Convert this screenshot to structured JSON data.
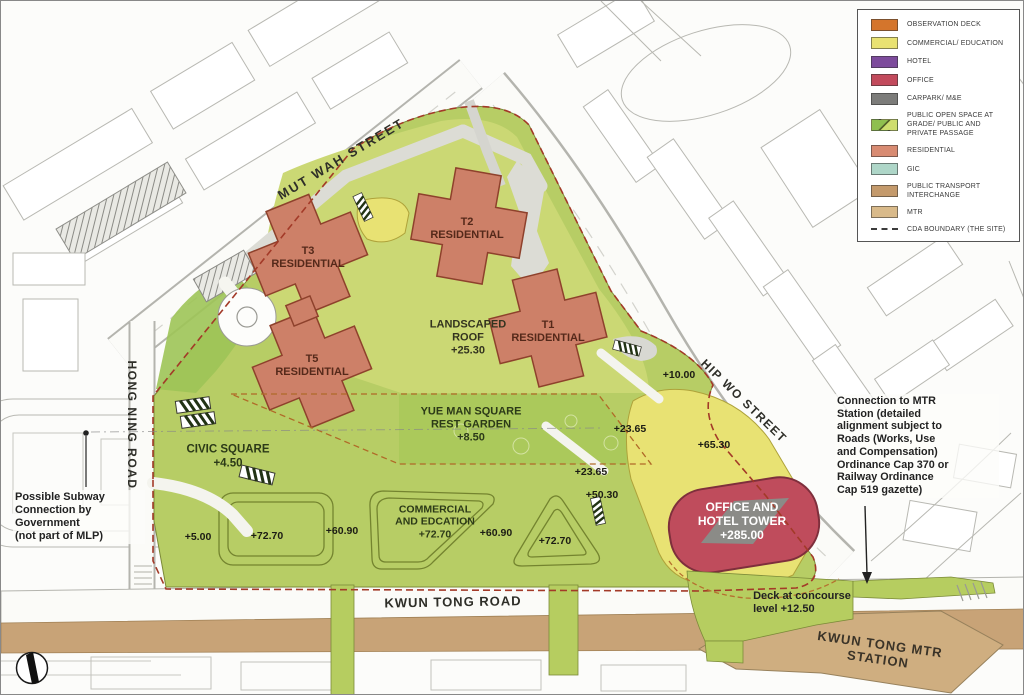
{
  "palette": {
    "observation_deck": "#d4752c",
    "commercial_education": "#e9e272",
    "hotel": "#7d4b9c",
    "office": "#c24a5c",
    "carpark_me": "#7c7c7a",
    "open_space_dark": "#8fbf4f",
    "open_space_light": "#cede6e",
    "residential": "#d88b72",
    "gic": "#aed6c8",
    "public_transport_interchange": "#c49a6c",
    "mtr": "#d9ba8a",
    "cda_boundary": "#a33a28",
    "site_green": "#b7cd65",
    "office_tower_red": "#bf4c5c"
  },
  "legend": {
    "items": [
      {
        "label": "OBSERVATION DECK",
        "color": "#d4752c"
      },
      {
        "label": "COMMERCIAL/ EDUCATION",
        "color": "#e9e272"
      },
      {
        "label": "HOTEL",
        "color": "#7d4b9c"
      },
      {
        "label": "OFFICE",
        "color": "#c24a5c"
      },
      {
        "label": "CARPARK/ M&E",
        "color": "#7c7c7a"
      },
      {
        "label": "PUBLIC OPEN SPACE AT GRADE/ PUBLIC AND PRIVATE PASSAGE",
        "color": "#9fc653"
      },
      {
        "label": "RESIDENTIAL",
        "color": "#d88b72"
      },
      {
        "label": "GIC",
        "color": "#aed6c8"
      },
      {
        "label": "PUBLIC TRANSPORT INTERCHANGE",
        "color": "#c49a6c"
      },
      {
        "label": "MTR",
        "color": "#d9ba8a"
      },
      {
        "label": "CDA BOUNDARY (THE SITE)",
        "color": "#444444"
      }
    ]
  },
  "streets": {
    "mut_wah": "MUT WAH STREET",
    "hong_ning": "HONG NING ROAD",
    "hip_wo": "HIP WO STREET",
    "kwun_tong": "KWUN TONG ROAD",
    "mtr_station": "KWUN TONG MTR STATION"
  },
  "buildings": {
    "t1": "T1\nRESIDENTIAL",
    "t2": "T2\nRESIDENTIAL",
    "t3": "T3\nRESIDENTIAL",
    "t5": "T5\nRESIDENTIAL",
    "office_hotel": "OFFICE AND\nHOTEL TOWER\n+285.00"
  },
  "areas": {
    "landscaped_roof": "LANDSCAPED\nROOF\n+25.30",
    "yue_man_square": "YUE MAN SQUARE\nREST GARDEN\n+8.50",
    "civic_square": "CIVIC SQUARE\n+4.50",
    "commercial_education": "COMMERCIAL\nAND EDCATION\n+72.70"
  },
  "levels": {
    "l10_00": "+10.00",
    "l23_65_a": "+23.65",
    "l23_65_b": "+23.65",
    "l50_30": "+50.30",
    "l65_30": "+65.30",
    "l5_00": "+5.00",
    "l72_70_a": "+72.70",
    "l60_90_a": "+60.90",
    "l60_90_b": "+60.90",
    "l72_70_b": "+72.70"
  },
  "annotations": {
    "subway": "Possible Subway\nConnection by\nGovernment\n(not part of MLP)",
    "mtr_connection": "Connection to MTR\nStation (detailed\nalignment subject to\nRoads (Works, Use\nand Compensation)\nOrdinance Cap 370 or\nRailway Ordinance\nCap 519 gazette)",
    "deck": "Deck at concourse\nlevel +12.50"
  }
}
